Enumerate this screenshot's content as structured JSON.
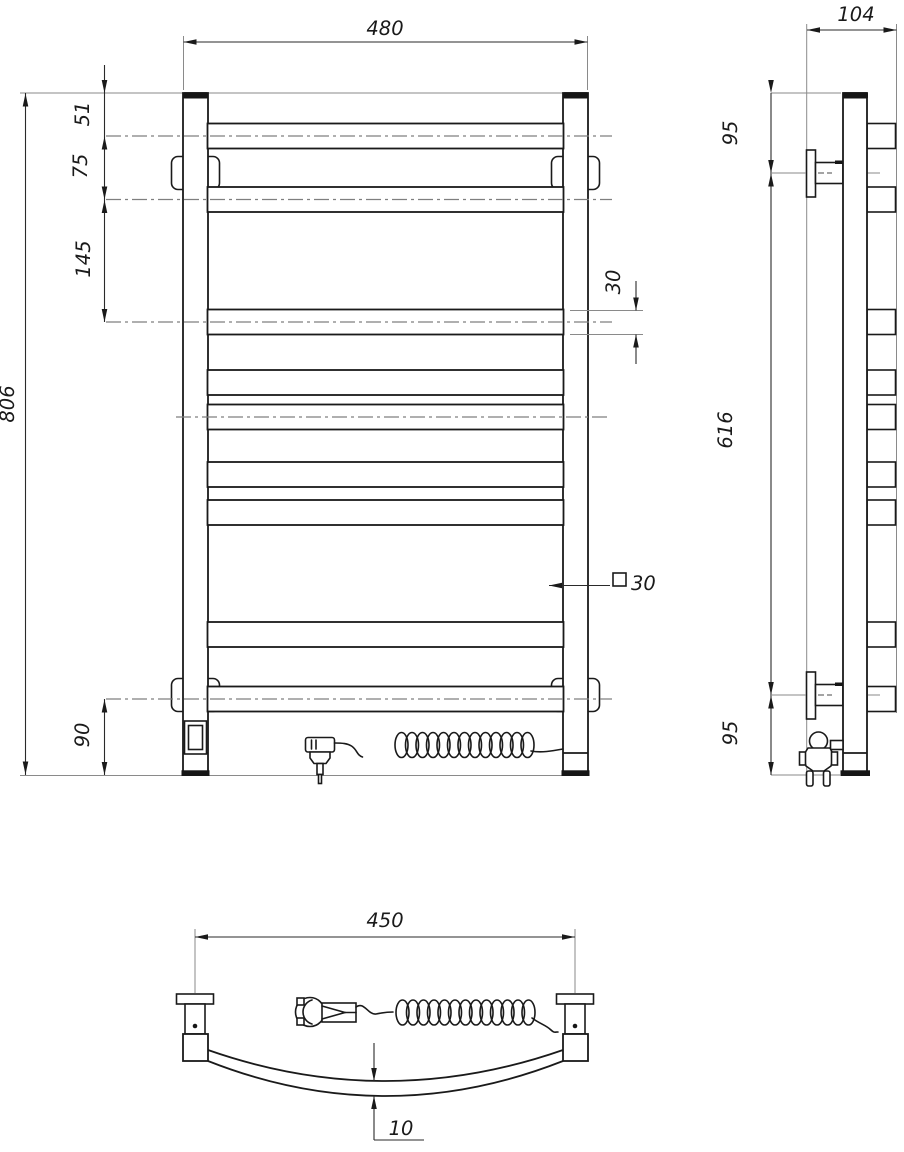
{
  "meta": {
    "subject": "ladder towel rail technical drawing, three orthographic views with electric plug and coiled cord"
  },
  "colors": {
    "background": "#ffffff",
    "line": "#1a1a1a",
    "dimension_line": "#2a2a2a",
    "extension_line": "#8a8a8a",
    "centerline": "#7f7f7f"
  },
  "dims": {
    "front_width": "480",
    "front_height": "806",
    "top_to_rung1": "51",
    "rung1_to_rung2": "75",
    "rung2_to_rung3": "145",
    "rung_tube": "30",
    "square_tube": "30",
    "bottom_offset": "90",
    "side_depth": "104",
    "side_top": "95",
    "side_span": "616",
    "side_bottom": "95",
    "plan_width": "450",
    "plan_bow": "10"
  }
}
